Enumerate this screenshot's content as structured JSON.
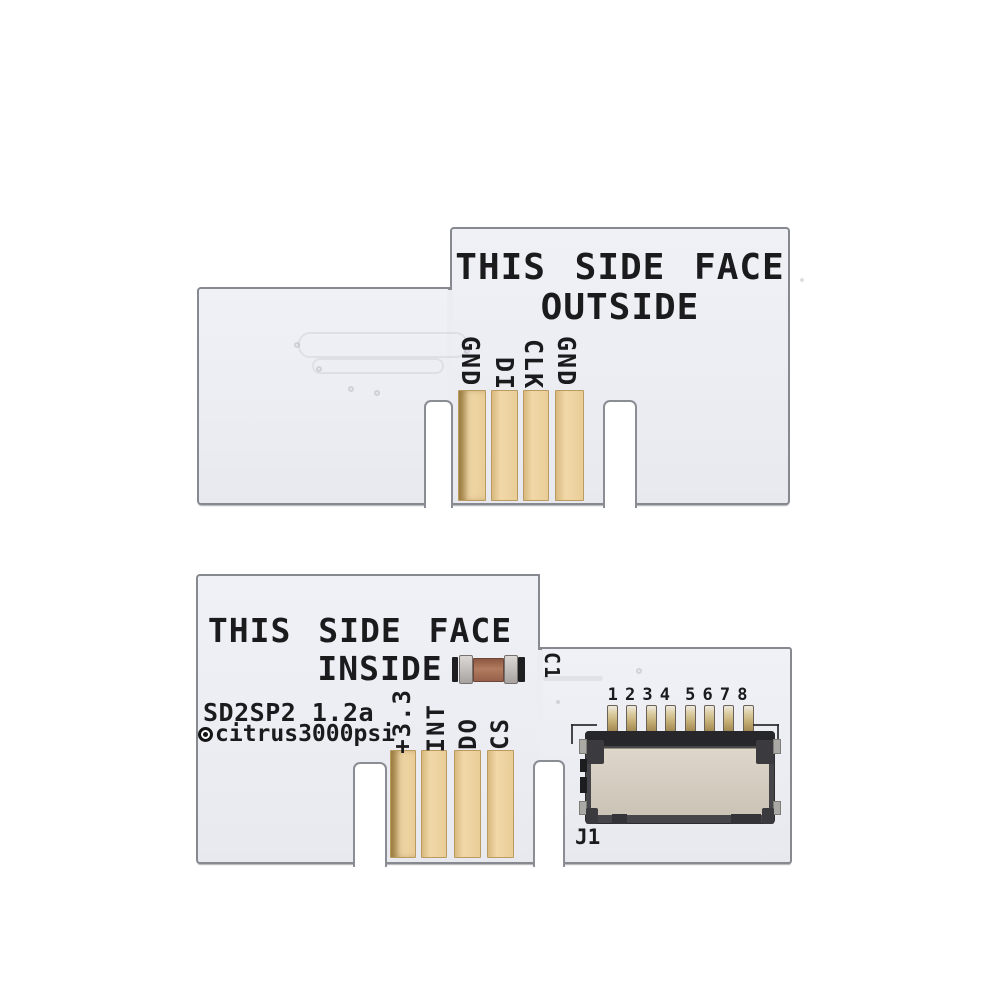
{
  "top_board": {
    "line1": "THIS SIDE FACE",
    "line2": "OUTSIDE",
    "pin_labels": [
      "GND",
      "DI",
      "CLK",
      "GND"
    ]
  },
  "bottom_board": {
    "line1": "THIS SIDE FACE",
    "line2": "INSIDE",
    "model": "SD2SP2 1.2a",
    "author": "citrus3000psi",
    "pin_labels": [
      "+3.3",
      "INT",
      "DO",
      "CS"
    ],
    "capacitor_label": "C1",
    "connector_label": "J1",
    "pin_numbers": [
      "1",
      "2",
      "3",
      "4",
      "5",
      "6",
      "7",
      "8"
    ]
  },
  "colors": {
    "background": "#ffffff",
    "board": "#ebedf3",
    "board_edge": "#86898f",
    "gold_pad": "#ecd0a0",
    "silkscreen": "#1b1b1d",
    "connector_body": "#cec6ba",
    "connector_frame": "#3b3b40",
    "capacitor_body": "#a5664d",
    "capacitor_end": "#b9b4b2"
  }
}
